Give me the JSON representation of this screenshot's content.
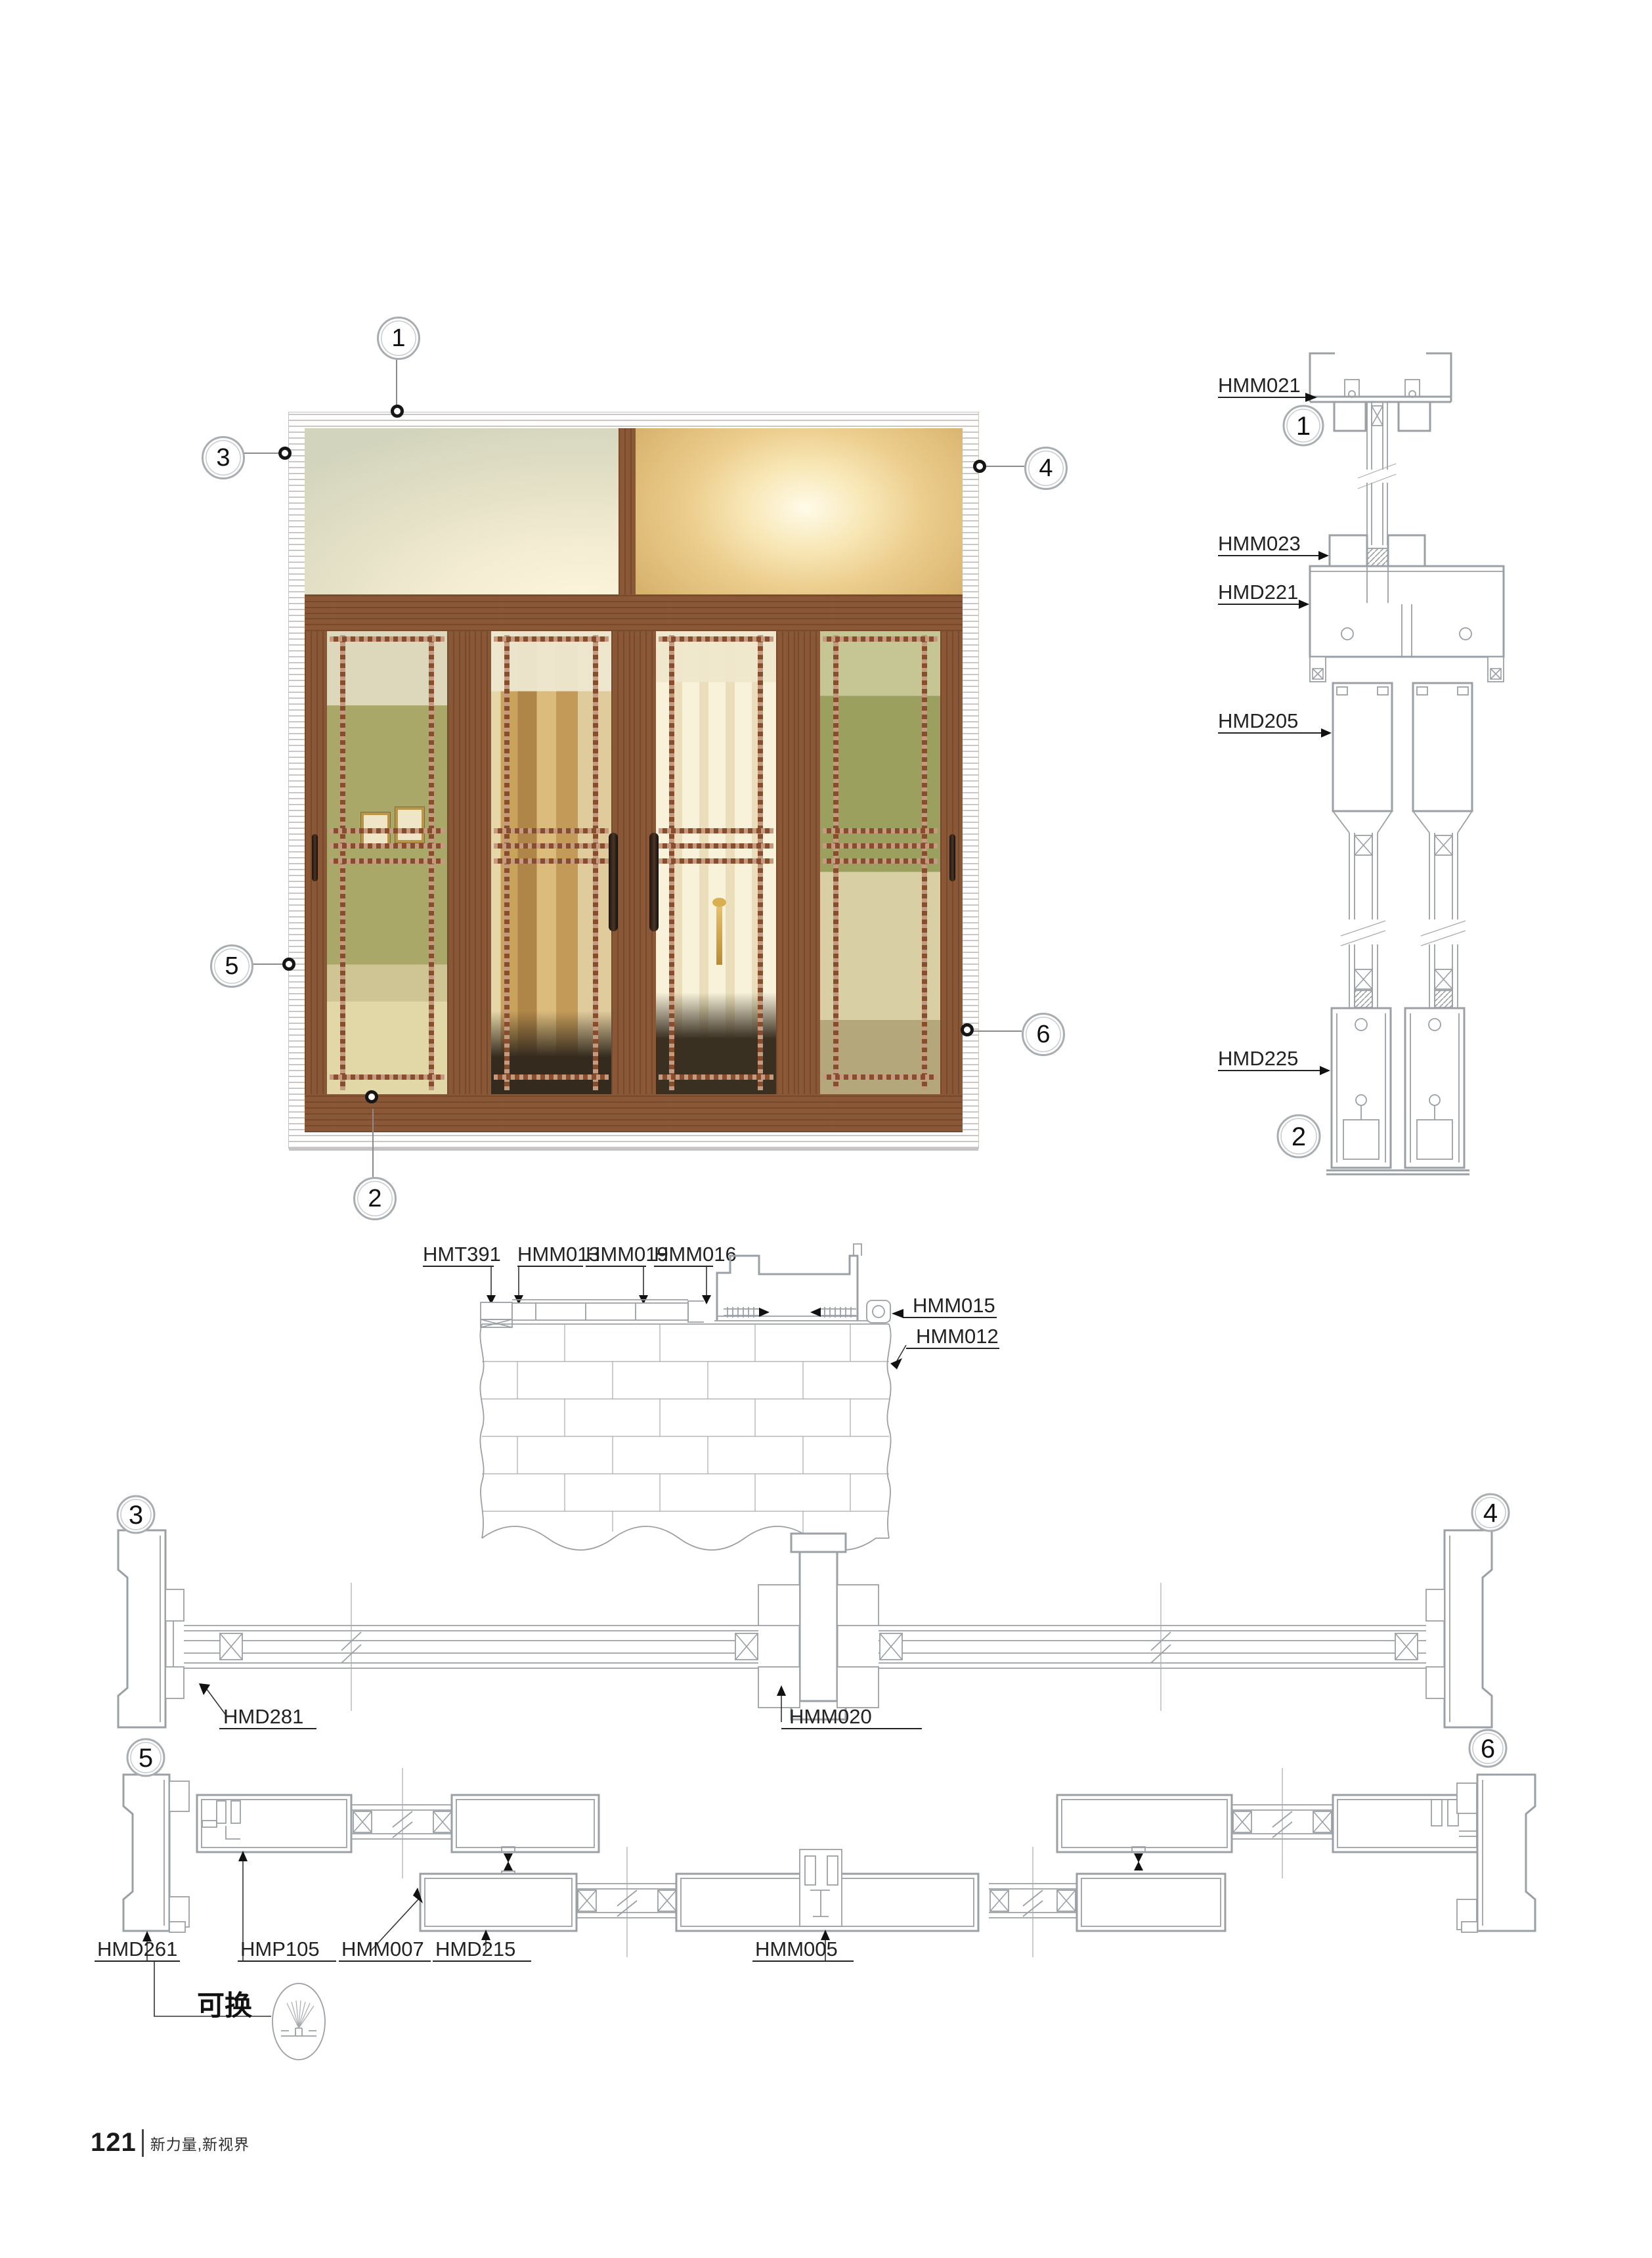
{
  "footer": {
    "page_number": "121",
    "tagline": "新力量,新视界"
  },
  "callouts": {
    "photo": [
      "1",
      "2",
      "3",
      "4",
      "5",
      "6"
    ],
    "vertical_section": [
      "1",
      "2"
    ],
    "plan_top": [
      "3",
      "4"
    ],
    "plan_bottom": [
      "5",
      "6"
    ]
  },
  "labels": {
    "vertical_section": [
      "HMM021",
      "HMM023",
      "HMD221",
      "HMD205",
      "HMD225"
    ],
    "wall_detail_top": [
      "HMT391",
      "HMM013",
      "HMM019",
      "HMM016"
    ],
    "wall_detail_right": [
      "HMM015",
      "HMM012"
    ],
    "plan_top": [
      "HMD281",
      "HMM020"
    ],
    "plan_bottom": [
      "HMD261",
      "HMP105",
      "HMM007",
      "HMD215",
      "HMM005"
    ]
  },
  "notes": {
    "replaceable": "可换"
  },
  "colors": {
    "cad_line": "#9aa0a6",
    "label_text": "#222222",
    "wood_dark": "#5f3a20",
    "wood_mid": "#8a5634",
    "wood_light": "#b9875a",
    "lattice_copper": "#a5663e",
    "glass_gold": "#f0d9a0",
    "glass_olive": "#a8a766"
  }
}
